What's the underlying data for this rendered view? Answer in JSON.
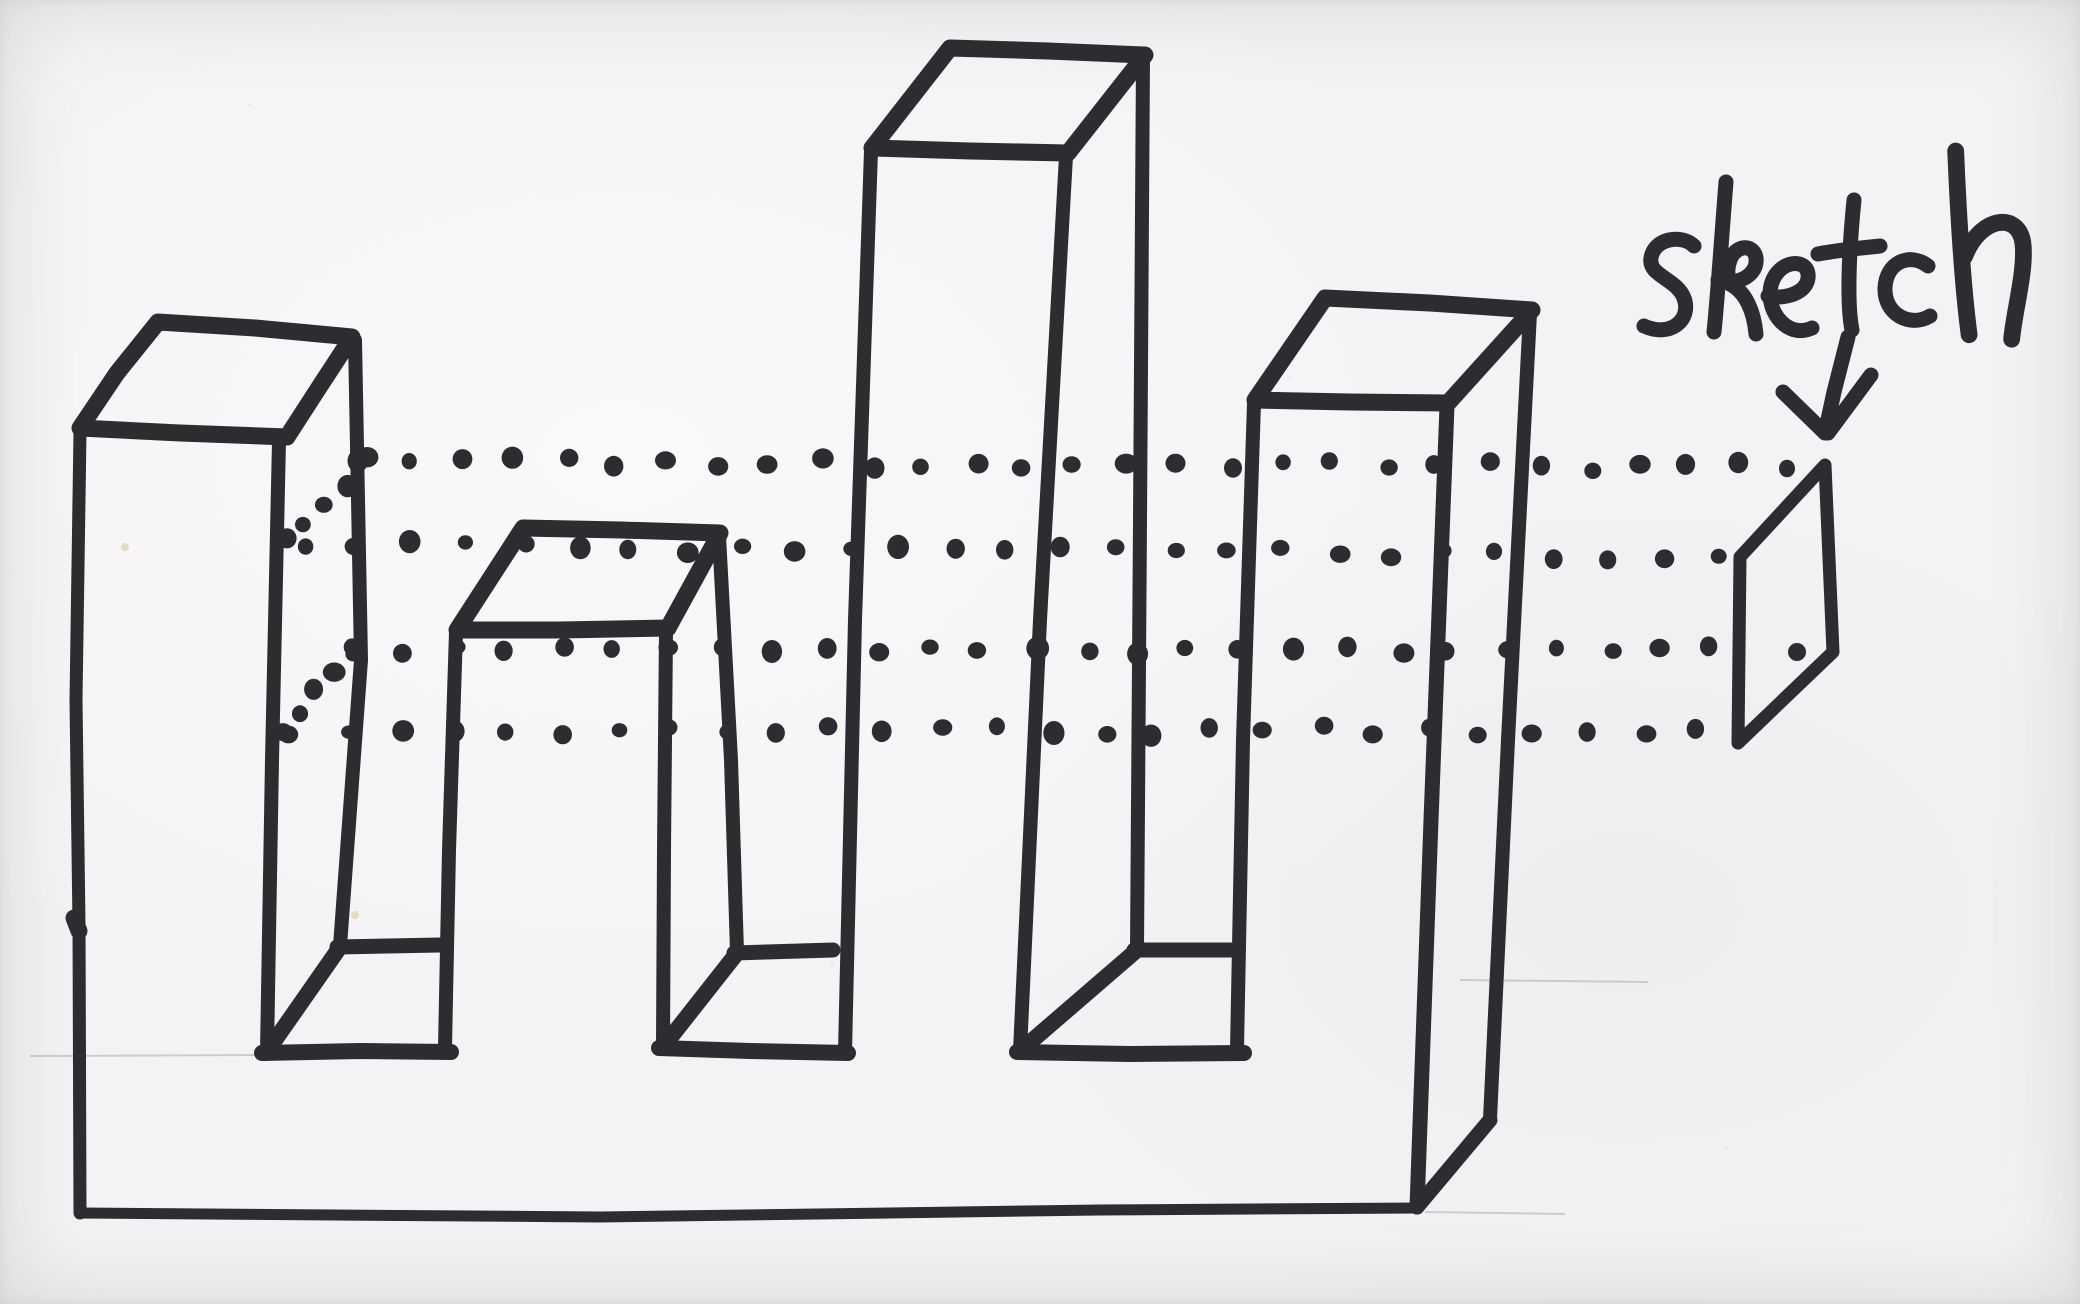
{
  "annotation": {
    "label": "sketch",
    "arrow_direction": "down"
  },
  "style": {
    "paper_color": "#f2f0f2",
    "ink_color": "#2c2d30",
    "pencil_color": "#8f8880",
    "speck_color": "#d8c98f"
  },
  "figure": {
    "strokes": [
      {
        "name": "tower-1-top-face",
        "w": 17,
        "closed": true,
        "pts": [
          [
            80,
            428
          ],
          [
            117,
            373
          ],
          [
            158,
            322
          ],
          [
            255,
            328
          ],
          [
            352,
            337
          ],
          [
            318,
            389
          ],
          [
            287,
            437
          ],
          [
            180,
            433
          ],
          [
            80,
            428
          ]
        ]
      },
      {
        "name": "tower-1-left-edge",
        "w": 13,
        "pts": [
          [
            80,
            432
          ],
          [
            76,
            700
          ],
          [
            79,
            925
          ],
          [
            80,
            1213
          ]
        ]
      },
      {
        "name": "tower-1-front-right-edge",
        "w": 14,
        "pts": [
          [
            279,
            441
          ],
          [
            272,
            760
          ],
          [
            267,
            1052
          ]
        ]
      },
      {
        "name": "tower-1-back-right-edge",
        "w": 14,
        "pts": [
          [
            355,
            340
          ],
          [
            361,
            660
          ],
          [
            340,
            946
          ]
        ]
      },
      {
        "name": "tower-2-top-face",
        "w": 17,
        "closed": true,
        "pts": [
          [
            457,
            630
          ],
          [
            523,
            528
          ],
          [
            621,
            530
          ],
          [
            720,
            533
          ],
          [
            668,
            628
          ],
          [
            560,
            630
          ],
          [
            457,
            630
          ]
        ]
      },
      {
        "name": "tower-2-front-left-edge",
        "w": 14,
        "pts": [
          [
            456,
            632
          ],
          [
            449,
            850
          ],
          [
            445,
            1047
          ]
        ]
      },
      {
        "name": "tower-2-front-right-edge",
        "w": 14,
        "pts": [
          [
            666,
            630
          ],
          [
            664,
            850
          ],
          [
            663,
            1046
          ]
        ]
      },
      {
        "name": "tower-2-back-right-edge",
        "w": 14,
        "pts": [
          [
            719,
            536
          ],
          [
            731,
            760
          ],
          [
            737,
            952
          ]
        ]
      },
      {
        "name": "tower-3-top-face",
        "w": 17,
        "closed": true,
        "pts": [
          [
            872,
            148
          ],
          [
            950,
            48
          ],
          [
            1048,
            51
          ],
          [
            1145,
            55
          ],
          [
            1068,
            153
          ],
          [
            970,
            151
          ],
          [
            872,
            148
          ]
        ]
      },
      {
        "name": "tower-3-front-left-edge",
        "w": 14,
        "pts": [
          [
            871,
            151
          ],
          [
            855,
            620
          ],
          [
            845,
            1052
          ]
        ]
      },
      {
        "name": "tower-3-front-right-edge",
        "w": 14,
        "pts": [
          [
            1066,
            156
          ],
          [
            1040,
            620
          ],
          [
            1020,
            1051
          ]
        ]
      },
      {
        "name": "tower-3-back-right-edge",
        "w": 14,
        "pts": [
          [
            1143,
            58
          ],
          [
            1140,
            520
          ],
          [
            1137,
            949
          ]
        ]
      },
      {
        "name": "tower-4-top-face",
        "w": 17,
        "closed": true,
        "pts": [
          [
            1255,
            400
          ],
          [
            1325,
            298
          ],
          [
            1430,
            303
          ],
          [
            1532,
            310
          ],
          [
            1448,
            403
          ],
          [
            1350,
            402
          ],
          [
            1255,
            400
          ]
        ]
      },
      {
        "name": "tower-4-front-left-edge",
        "w": 14,
        "pts": [
          [
            1254,
            403
          ],
          [
            1243,
            740
          ],
          [
            1237,
            1049
          ]
        ]
      },
      {
        "name": "tower-4-front-right-edge",
        "w": 15,
        "pts": [
          [
            1447,
            406
          ],
          [
            1431,
            820
          ],
          [
            1417,
            1207
          ]
        ]
      },
      {
        "name": "tower-4-back-right-edge",
        "w": 14,
        "pts": [
          [
            1530,
            313
          ],
          [
            1508,
            740
          ],
          [
            1490,
            1119
          ]
        ]
      },
      {
        "name": "valley-1-floor-front-edge",
        "w": 16,
        "pts": [
          [
            262,
            1053
          ],
          [
            360,
            1051
          ],
          [
            451,
            1052
          ]
        ]
      },
      {
        "name": "valley-1-floor-back-edge",
        "w": 15,
        "pts": [
          [
            337,
            947
          ],
          [
            440,
            945
          ]
        ]
      },
      {
        "name": "valley-1-floor-left-diagonal",
        "w": 16,
        "pts": [
          [
            266,
            1053
          ],
          [
            340,
            947
          ]
        ]
      },
      {
        "name": "valley-2-floor-front-edge",
        "w": 16,
        "pts": [
          [
            659,
            1048
          ],
          [
            750,
            1051
          ],
          [
            848,
            1053
          ]
        ]
      },
      {
        "name": "valley-2-floor-back-edge",
        "w": 15,
        "pts": [
          [
            734,
            953
          ],
          [
            833,
            950
          ]
        ]
      },
      {
        "name": "valley-2-floor-left-diagonal",
        "w": 16,
        "pts": [
          [
            663,
            1047
          ],
          [
            737,
            953
          ]
        ]
      },
      {
        "name": "valley-3-floor-front-edge",
        "w": 16,
        "pts": [
          [
            1017,
            1052
          ],
          [
            1130,
            1054
          ],
          [
            1244,
            1053
          ]
        ]
      },
      {
        "name": "valley-3-floor-back-edge",
        "w": 15,
        "pts": [
          [
            1134,
            950
          ],
          [
            1237,
            950
          ]
        ]
      },
      {
        "name": "valley-3-floor-left-diagonal",
        "w": 16,
        "pts": [
          [
            1020,
            1051
          ],
          [
            1137,
            950
          ]
        ]
      },
      {
        "name": "base-bottom-front-edge",
        "w": 11,
        "pts": [
          [
            80,
            1213
          ],
          [
            600,
            1217
          ],
          [
            1100,
            1210
          ],
          [
            1417,
            1208
          ]
        ]
      },
      {
        "name": "base-bottom-right-diagonal",
        "w": 15,
        "pts": [
          [
            1417,
            1207
          ],
          [
            1490,
            1120
          ]
        ]
      },
      {
        "name": "sketch-profile-face",
        "w": 13,
        "closed": true,
        "pts": [
          [
            1825,
            465
          ],
          [
            1833,
            652
          ],
          [
            1738,
            743
          ],
          [
            1740,
            557
          ],
          [
            1825,
            465
          ]
        ]
      },
      {
        "name": "arrow-shaft",
        "w": 15,
        "pts": [
          [
            1848,
            337
          ],
          [
            1834,
            392
          ],
          [
            1826,
            429
          ]
        ]
      },
      {
        "name": "arrow-barb-left",
        "w": 15,
        "pts": [
          [
            1783,
            392
          ],
          [
            1825,
            433
          ]
        ]
      },
      {
        "name": "arrow-barb-right",
        "w": 15,
        "pts": [
          [
            1871,
            375
          ],
          [
            1828,
            433
          ]
        ]
      },
      {
        "name": "ink-blob-left-edge",
        "w": 17,
        "pts": [
          [
            74,
            918
          ],
          [
            79,
            931
          ]
        ]
      }
    ],
    "dotted_lines": [
      {
        "name": "projection-dotted-line-1",
        "from": [
          362,
          461
        ],
        "to": [
          1793,
          467
        ],
        "n": 29
      },
      {
        "name": "projection-dotted-line-2",
        "from": [
          303,
          545
        ],
        "to": [
          1716,
          556
        ],
        "n": 27
      },
      {
        "name": "projection-dotted-line-3",
        "from": [
          352,
          650
        ],
        "to": [
          1712,
          650
        ],
        "n": 27
      },
      {
        "name": "projection-dotted-line-4",
        "from": [
          291,
          732
        ],
        "to": [
          1697,
          730
        ],
        "n": 27
      },
      {
        "name": "projection-dotted-diagonal-1",
        "from": [
          363,
          463
        ],
        "to": [
          288,
          541
        ],
        "n": 5
      },
      {
        "name": "projection-dotted-diagonal-2",
        "from": [
          349,
          651
        ],
        "to": [
          288,
          731
        ],
        "n": 5
      }
    ],
    "extra_dots": [
      {
        "name": "dot-inside-profile",
        "x": 1797,
        "y": 652,
        "r": 9
      }
    ],
    "pencil_lines": [
      {
        "name": "pencil-guide-1",
        "pts": [
          [
            30,
            1056
          ],
          [
            255,
            1055
          ]
        ]
      },
      {
        "name": "pencil-guide-2",
        "pts": [
          [
            1425,
            1212
          ],
          [
            1565,
            1214
          ]
        ]
      },
      {
        "name": "pencil-guide-3",
        "pts": [
          [
            1460,
            980
          ],
          [
            1648,
            982
          ]
        ]
      }
    ],
    "specks": [
      {
        "x": 125,
        "y": 547,
        "r": 4
      },
      {
        "x": 355,
        "y": 915,
        "r": 4
      }
    ]
  }
}
